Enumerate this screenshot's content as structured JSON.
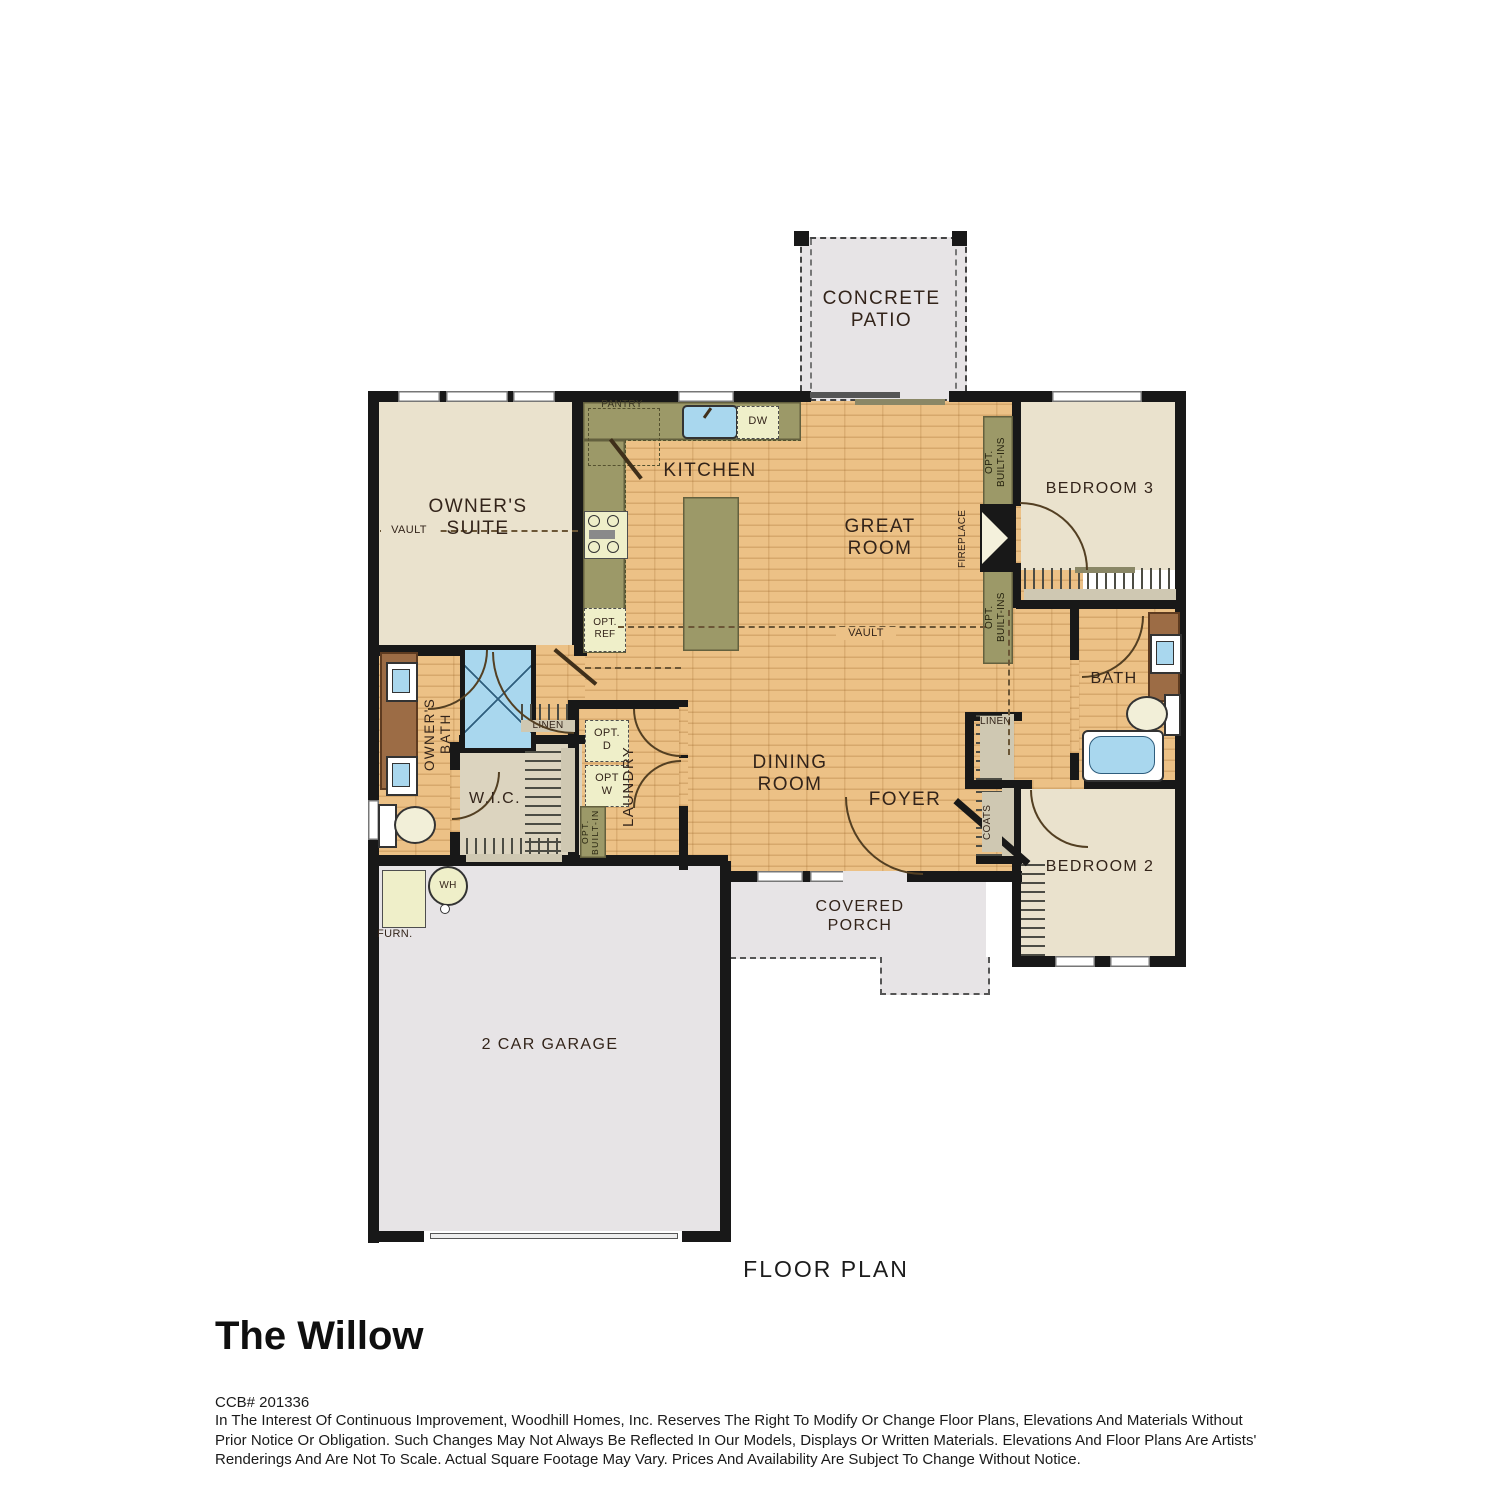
{
  "plan": {
    "patio": {
      "label": "CONCRETE\nPATIO"
    },
    "rooms": {
      "owners_suite": "OWNER'S\nSUITE",
      "kitchen": "KITCHEN",
      "great_room": "GREAT\nROOM",
      "dining_room": "DINING\nROOM",
      "foyer": "FOYER",
      "bedroom2": "BEDROOM 2",
      "bedroom3": "BEDROOM 3",
      "bath": "BATH",
      "owners_bath": "OWNER'S\nBATH",
      "wic": "W.I.C.",
      "laundry": "LAUNDRY",
      "garage": "2 CAR GARAGE",
      "covered_porch": "COVERED\nPORCH"
    },
    "features": {
      "pantry": "PANTRY",
      "dw": "DW",
      "opt_ref": "OPT.\nREF",
      "vault": "VAULT",
      "fireplace": "FIREPLACE",
      "opt_builtins": "OPT.\nBUILT-INS",
      "opt_builtin": "OPT.\nBUILT-IN",
      "opt_d": "OPT.\nD",
      "opt_w": "OPT\nW",
      "linen": "LINEN",
      "coats": "COATS",
      "furn": "FURN.",
      "wh": "WH"
    }
  },
  "caption": "FLOOR PLAN",
  "footer": {
    "title": "The Willow",
    "ccb": "CCB# 201336",
    "disclaimer": "In The Interest Of Continuous Improvement, Woodhill Homes, Inc. Reserves The Right To Modify Or Change Floor Plans, Elevations And Materials Without\nPrior Notice Or Obligation. Such Changes May Not Always Be Reflected In Our Models, Displays Or Written Materials. Elevations And Floor Plans Are Artists'\nRenderings And Are Not To Scale. Actual Square Footage May Vary. Prices And Availability Are Subject To Change Without Notice."
  },
  "colors": {
    "wood_floor": "#ECC186",
    "carpet": "#EAE2CD",
    "concrete_gray": "#E7E4E6",
    "counter_olive": "#9C9968",
    "vanity_brown": "#9C6C45",
    "fixture_blue": "#A9D7EE",
    "appliance_cream": "#EFEFC9",
    "wall_black": "#181818"
  }
}
